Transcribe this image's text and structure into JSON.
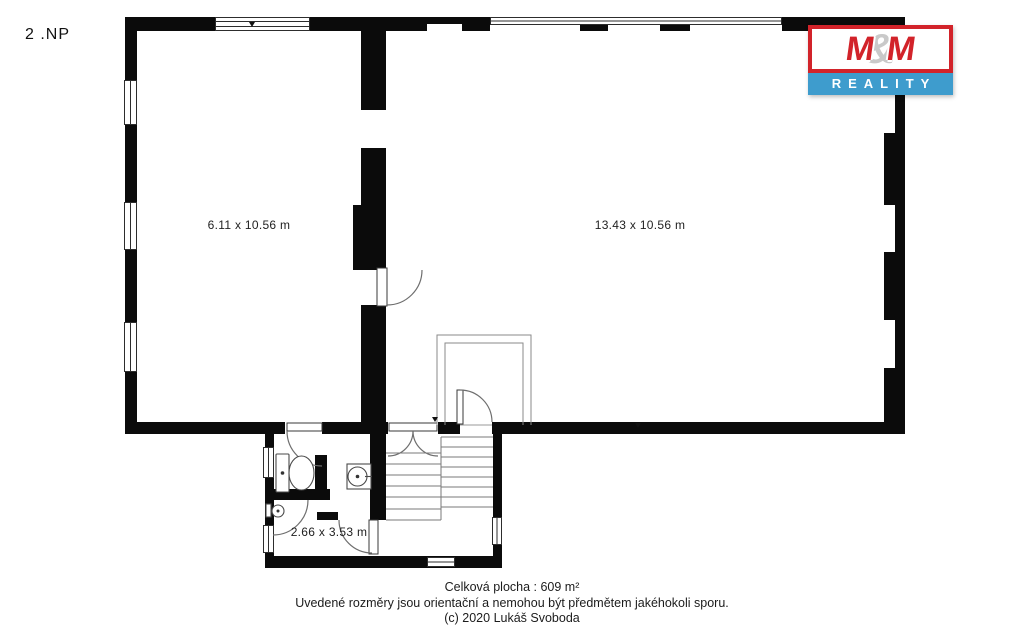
{
  "plan": {
    "floor_label": "2 .NP",
    "rooms": [
      {
        "name": "left-room",
        "dimensions": "6.11 x 10.56 m"
      },
      {
        "name": "right-room",
        "dimensions": "13.43 x 10.56 m"
      },
      {
        "name": "bathroom",
        "dimensions": "2.66 x 3.53 m"
      }
    ]
  },
  "logo": {
    "m1": "M",
    "amp": "&",
    "m2": "M",
    "subtitle": "REALITY",
    "red": "#d2232a",
    "blue": "#3e9ccd",
    "gray": "#c9c9c9"
  },
  "footer": {
    "line1": "Celková plocha : 609 m²",
    "line2": "Uvedené rozměry jsou orientační a nemohou být předmětem jakéhokoli sporu.",
    "line3": "(c) 2020 Lukáš Svoboda"
  }
}
